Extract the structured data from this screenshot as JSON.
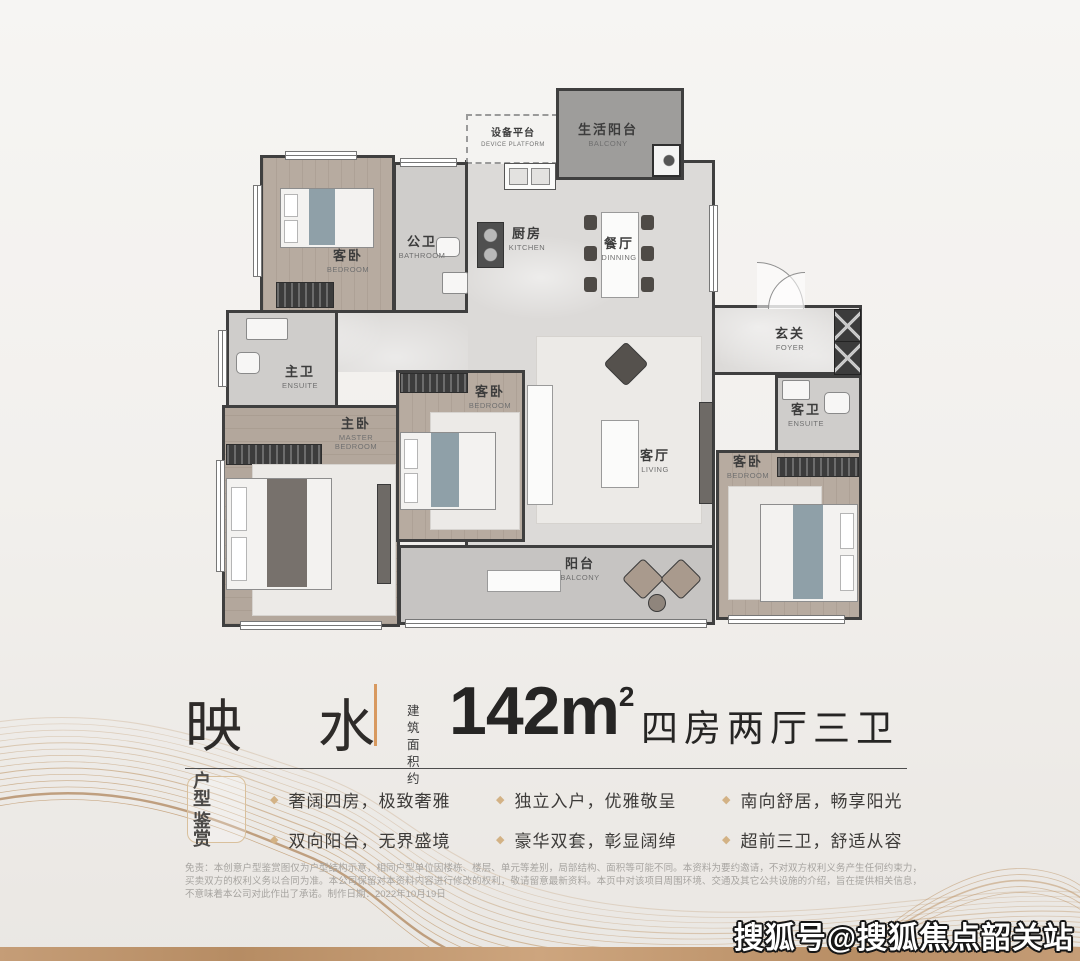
{
  "accent_colors": {
    "gold_line": "#bb905f",
    "divider_orange": "#d8995f",
    "badge_border": "#d9c09c",
    "diamond_bullet": "#d3b285",
    "bottom_bar": "#c59d77",
    "wall": "#3f3f3f"
  },
  "floorplan": {
    "rooms": [
      {
        "id": "device-platform",
        "zh": "设备平台",
        "en": "DEVICE PLATFORM"
      },
      {
        "id": "life-balcony",
        "zh": "生活阳台",
        "en": "BALCONY"
      },
      {
        "id": "bedroom-top-left",
        "zh": "客卧",
        "en": "BEDROOM"
      },
      {
        "id": "public-bathroom",
        "zh": "公卫",
        "en": "BATHROOM"
      },
      {
        "id": "kitchen",
        "zh": "厨房",
        "en": "KITCHEN"
      },
      {
        "id": "dining",
        "zh": "餐厅",
        "en": "DINNING"
      },
      {
        "id": "foyer",
        "zh": "玄关",
        "en": "FOYER"
      },
      {
        "id": "master-ensuite",
        "zh": "主卫",
        "en": "ENSUITE"
      },
      {
        "id": "master-bedroom",
        "zh": "主卧",
        "en": "MASTER BEDROOM"
      },
      {
        "id": "bedroom-middle",
        "zh": "客卧",
        "en": "BEDROOM"
      },
      {
        "id": "living",
        "zh": "客厅",
        "en": "LIVING"
      },
      {
        "id": "guest-ensuite",
        "zh": "客卫",
        "en": "ENSUITE"
      },
      {
        "id": "bedroom-right",
        "zh": "客卧",
        "en": "BEDROOM"
      },
      {
        "id": "balcony",
        "zh": "阳台",
        "en": "BALCONY"
      }
    ]
  },
  "title": {
    "name": "映 水",
    "area_label_line1": "建 筑",
    "area_label_line2": "面积约",
    "area_value": "142m",
    "area_exponent": "2",
    "layout": "四房两厅三卫"
  },
  "badge": {
    "line1": "户 型",
    "line2": "鉴 赏"
  },
  "features": {
    "bullet": "◆",
    "columns": [
      {
        "items": [
          "奢阔四房，极致奢雅",
          "双向阳台，无界盛境"
        ]
      },
      {
        "items": [
          "独立入户，优雅敬呈",
          "豪华双套，彰显阔绰"
        ]
      },
      {
        "items": [
          "南向舒居，畅享阳光",
          "超前三卫，舒适从容"
        ]
      }
    ]
  },
  "disclaimer": {
    "text": "免责：本创意户型鉴赏图仅为户型结构示意，相同户型单位因楼栋、楼层、单元等差别，局部结构、面积等可能不同。本资料为要约邀请，不对双方权利义务产生任何约束力，买卖双方的权利义务以合同为准。本公司保留对本资料内容进行修改的权利，敬请留意最新资料。本页中对该项目周围环境、交通及其它公共设施的介绍，旨在提供相关信息，不意味着本公司对此作出了承诺。制作日期：2022年10月19日"
  },
  "watermark": "搜狐号@搜狐焦点韶关站"
}
